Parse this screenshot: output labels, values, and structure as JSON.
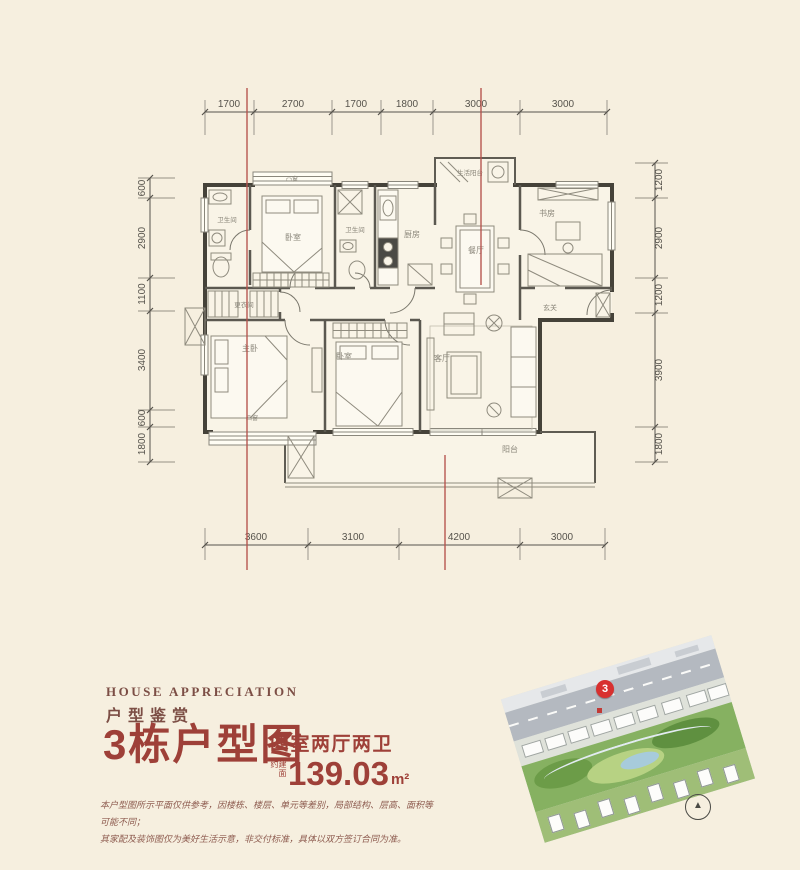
{
  "colors": {
    "background": "#f6efdf",
    "accent_red": "#9e4038",
    "dimension_red_line": "#b5524c",
    "marker_red": "#d8302f"
  },
  "plan": {
    "dims_top": [
      "1700",
      "2700",
      "1700",
      "1800",
      "3000",
      "3000"
    ],
    "dims_bottom": [
      "3600",
      "3100",
      "4200",
      "3000"
    ],
    "dims_left": [
      "600",
      "2900",
      "1100",
      "3400",
      "600",
      "1800"
    ],
    "dims_right": [
      "1200",
      "2900",
      "1200",
      "3900",
      "1800"
    ],
    "rooms": {
      "bay_top": "凸窗",
      "bedroom_top": "卧室",
      "bath1": "卫生间",
      "bath2": "卫生间",
      "kitchen": "厨房",
      "dining": "餐厅",
      "service_balcony": "生活阳台",
      "study": "书房",
      "entry": "玄关",
      "dressing": "更衣间",
      "master": "主卧",
      "bedroom2": "卧室",
      "living": "客厅",
      "balcony": "阳台",
      "bay_bottom": "凸窗"
    }
  },
  "info": {
    "eyebrow_en": "HOUSE APPRECIATION",
    "eyebrow_cn": "户型鉴赏",
    "title": "3栋户型图",
    "subtitle": "四室两厅两卫",
    "area_prefix": "建面约",
    "area_value": "139.03",
    "area_unit": "m²",
    "disclaimer_line1": "本户型图所示平面仅供参考，因楼栋、楼层、单元等差别，局部结构、层高、面积等可能不同；",
    "disclaimer_line2": "其家配及装饰图仅为美好生活示意，非交付标准，具体以双方签订合同为准。"
  },
  "sitemap": {
    "building_badge": "3"
  }
}
